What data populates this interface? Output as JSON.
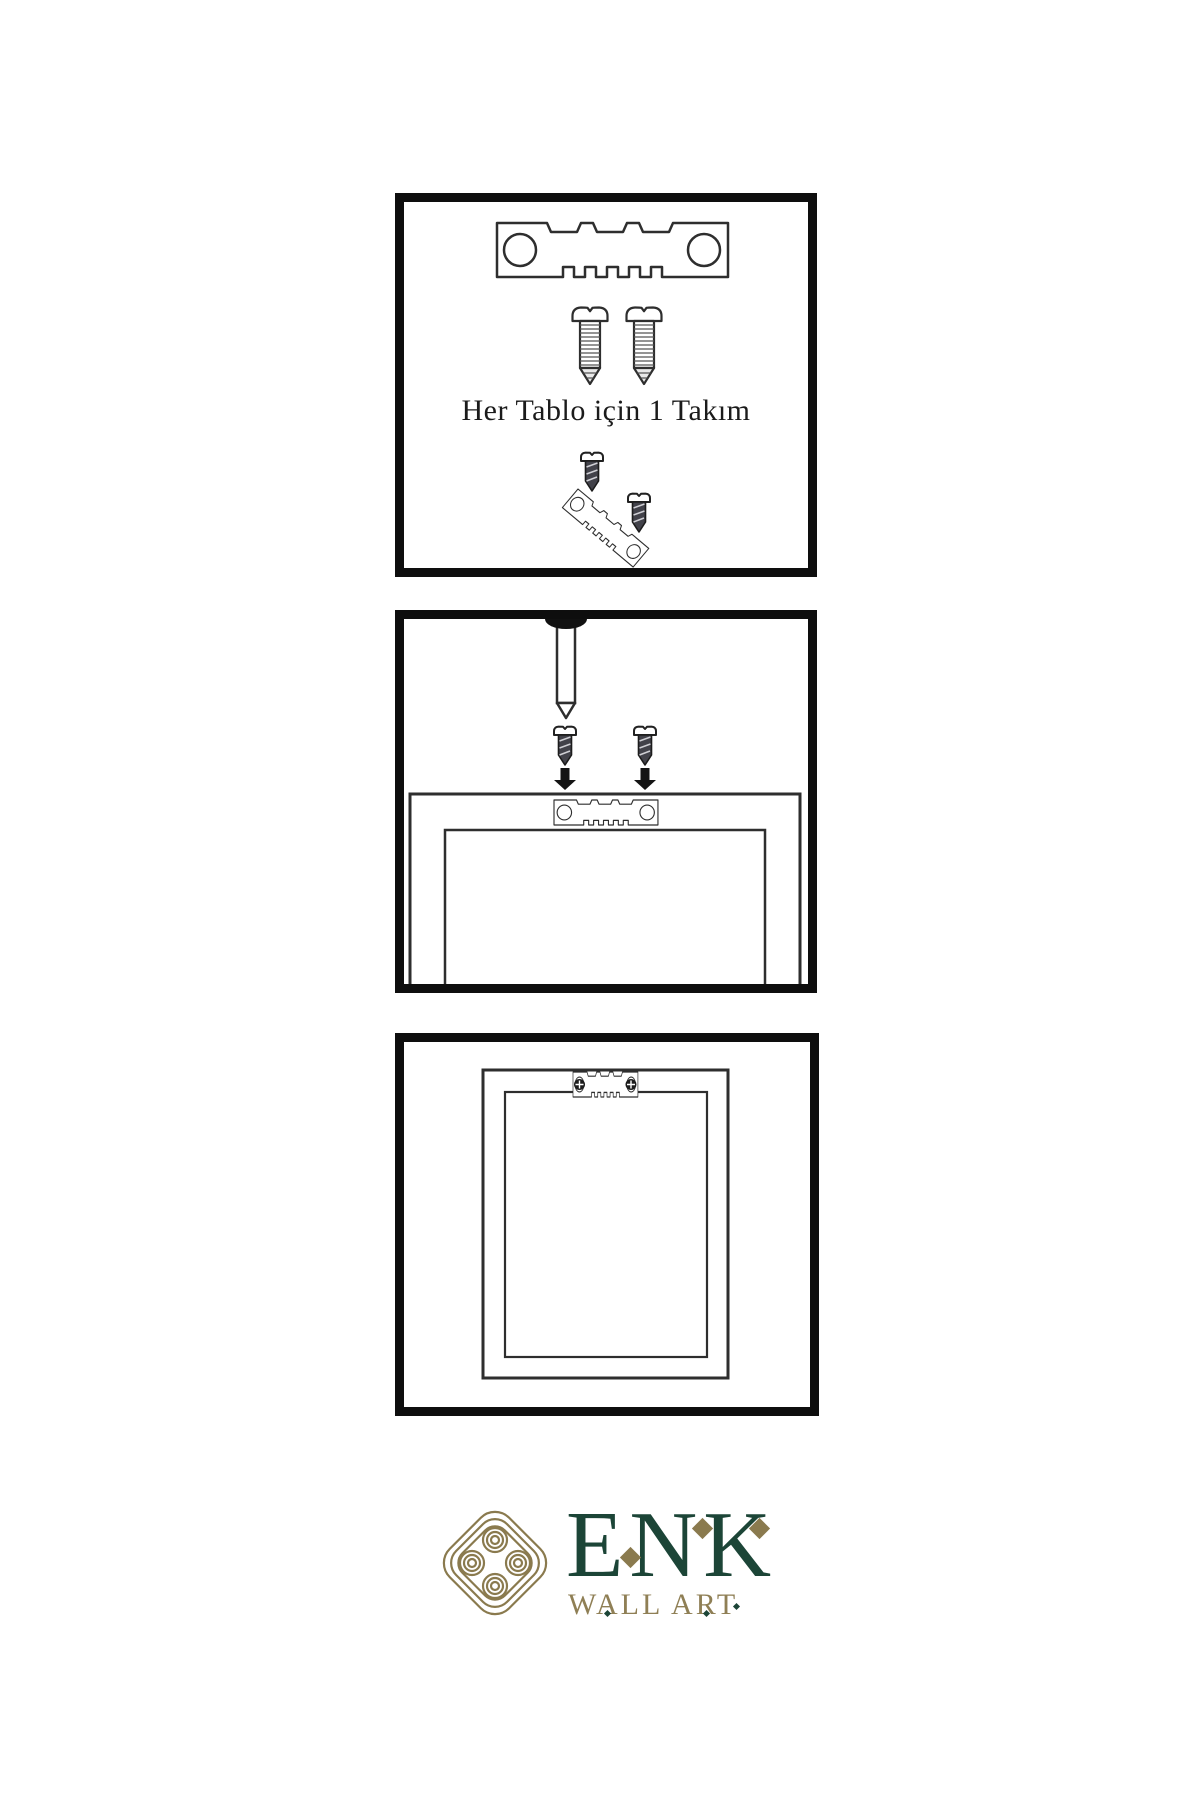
{
  "instruction": {
    "caption": "Her Tablo için 1 Takım"
  },
  "brand": {
    "name": "ENK",
    "subtitle": "WALL ART",
    "name_color": "#1C4537",
    "gold_color": "#8A7A4E",
    "subtitle_color": "#8F7F55"
  },
  "artwork": {
    "panel_border_color": "#0E0E0E",
    "line_color": "#2E2E2E",
    "icons": [
      "sawtooth-hanger-icon",
      "screw-icon",
      "dark-screw-icon",
      "wall-nail-icon",
      "down-arrow-icon",
      "picture-frame-icon",
      "knot-logo-icon"
    ]
  }
}
